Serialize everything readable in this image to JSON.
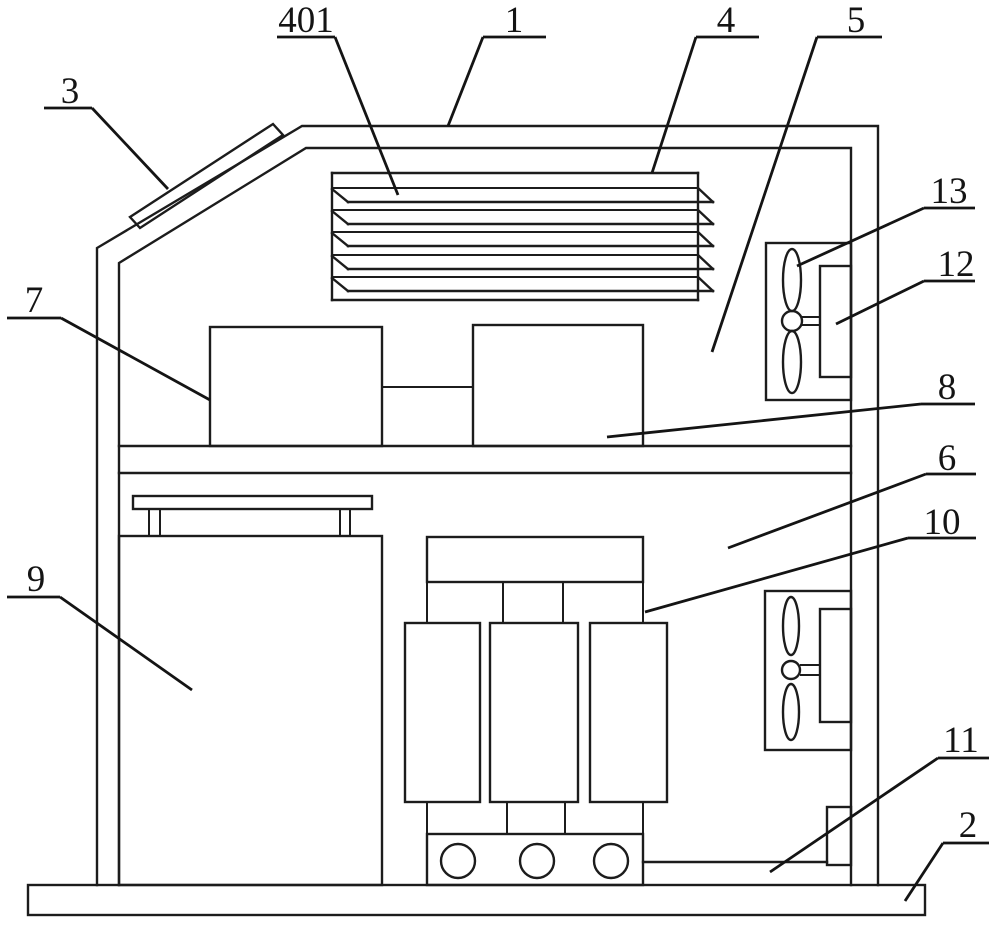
{
  "figure": {
    "type": "patent-line-drawing",
    "background_color": "#ffffff",
    "line_color": "#1c1c1c",
    "reference_numbers": [
      "401",
      "1",
      "4",
      "5",
      "3",
      "13",
      "12",
      "7",
      "8",
      "6",
      "10",
      "9",
      "11",
      "2"
    ]
  },
  "labels": [
    {
      "text": "401",
      "tx": 306,
      "ty": 32,
      "underline": [
        277,
        37,
        335,
        37
      ],
      "leader": [
        335,
        37,
        398,
        195
      ]
    },
    {
      "text": "1",
      "tx": 514,
      "ty": 32,
      "underline": [
        483,
        37,
        546,
        37
      ],
      "leader": [
        483,
        37,
        448,
        126
      ]
    },
    {
      "text": "4",
      "tx": 726,
      "ty": 32,
      "underline": [
        696,
        37,
        759,
        37
      ],
      "leader": [
        696,
        37,
        652,
        173
      ]
    },
    {
      "text": "5",
      "tx": 856,
      "ty": 32,
      "underline": [
        817,
        37,
        882,
        37
      ],
      "leader": [
        817,
        37,
        712,
        352
      ]
    },
    {
      "text": "3",
      "tx": 70,
      "ty": 103,
      "underline": [
        44,
        108,
        92,
        108
      ],
      "leader": [
        92,
        108,
        168,
        189
      ]
    },
    {
      "text": "13",
      "tx": 949,
      "ty": 203,
      "underline": [
        924,
        208,
        975,
        208
      ],
      "leader": [
        924,
        208,
        797,
        266
      ]
    },
    {
      "text": "12",
      "tx": 956,
      "ty": 276,
      "underline": [
        924,
        281,
        975,
        281
      ],
      "leader": [
        924,
        281,
        836,
        324
      ]
    },
    {
      "text": "7",
      "tx": 34,
      "ty": 312,
      "underline": [
        7,
        318,
        61,
        318
      ],
      "leader": [
        61,
        318,
        210,
        400
      ]
    },
    {
      "text": "8",
      "tx": 947,
      "ty": 399,
      "underline": [
        921,
        404,
        975,
        404
      ],
      "leader": [
        921,
        404,
        607,
        437
      ]
    },
    {
      "text": "6",
      "tx": 947,
      "ty": 470,
      "underline": [
        926,
        474,
        976,
        474
      ],
      "leader": [
        926,
        474,
        728,
        548
      ]
    },
    {
      "text": "10",
      "tx": 942,
      "ty": 534,
      "underline": [
        908,
        538,
        976,
        538
      ],
      "leader": [
        908,
        538,
        645,
        612
      ]
    },
    {
      "text": "9",
      "tx": 36,
      "ty": 591,
      "underline": [
        7,
        597,
        60,
        597
      ],
      "leader": [
        60,
        597,
        192,
        690
      ]
    },
    {
      "text": "11",
      "tx": 961,
      "ty": 752,
      "underline": [
        938,
        758,
        989,
        758
      ],
      "leader": [
        938,
        758,
        770,
        872
      ]
    },
    {
      "text": "2",
      "tx": 968,
      "ty": 837,
      "underline": [
        943,
        843,
        989,
        843
      ],
      "leader": [
        943,
        843,
        905,
        901
      ]
    }
  ]
}
